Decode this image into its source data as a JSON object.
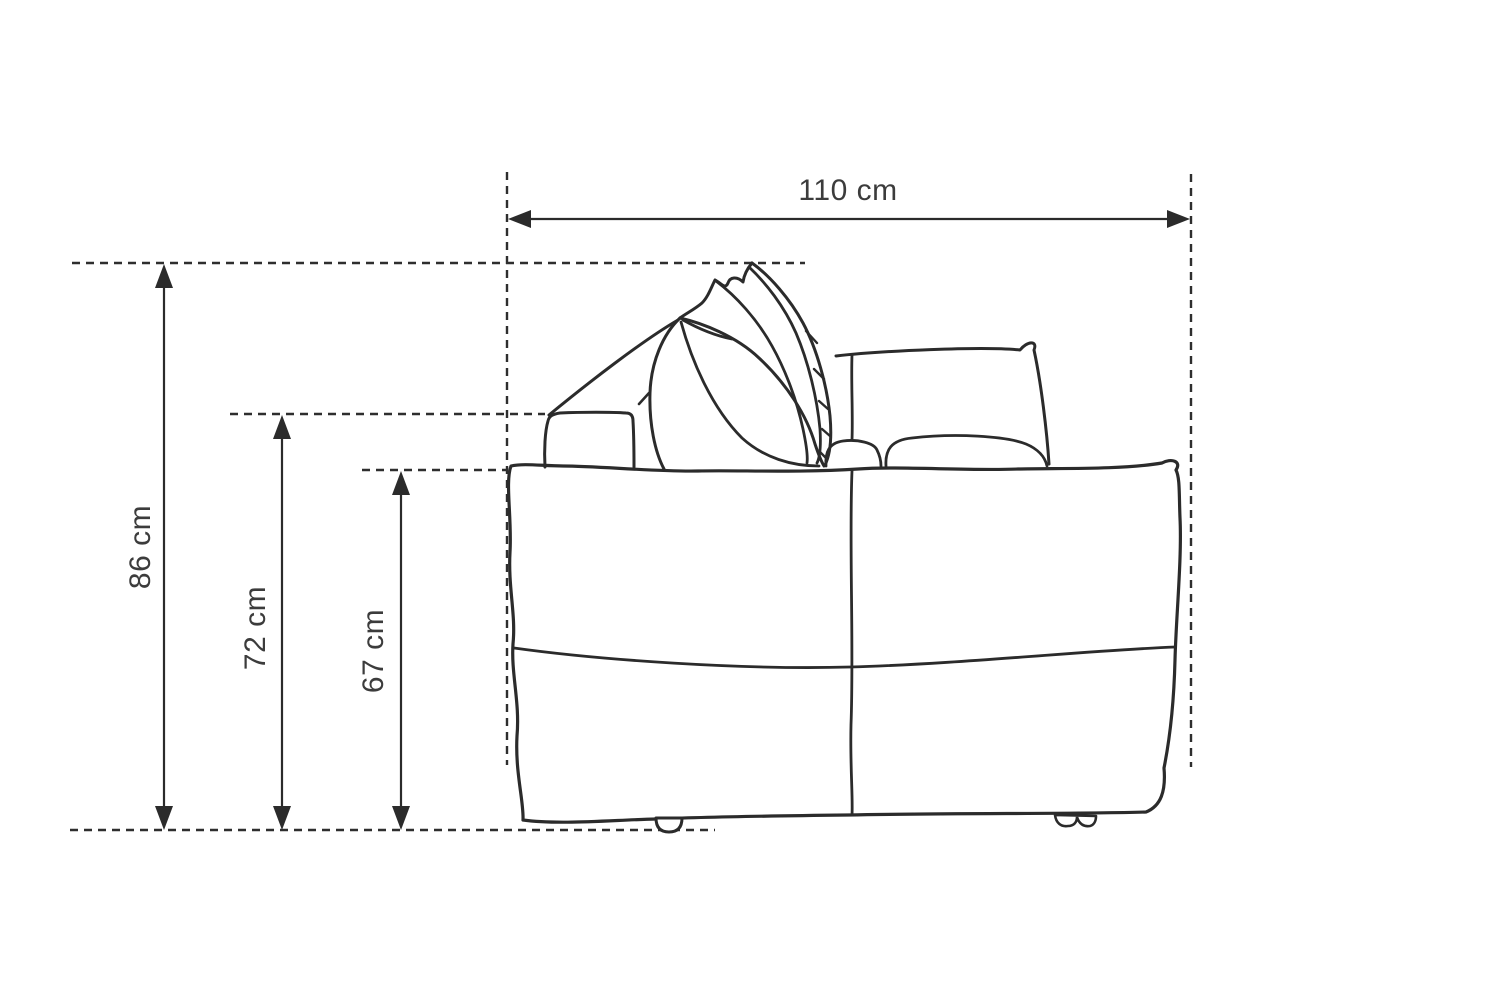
{
  "diagram": {
    "subject": "sofa side-view line drawing with dimension annotations",
    "unit": "cm",
    "background": "#ffffff",
    "line_color": "#2b2b2b",
    "text_color": "#3c3c3c",
    "dimensions": {
      "overall_width": {
        "label": "110 cm",
        "value": 110,
        "axis": "horizontal"
      },
      "overall_height": {
        "label": "86 cm",
        "value": 86,
        "axis": "vertical"
      },
      "backrest_height": {
        "label": "72 cm",
        "value": 72,
        "axis": "vertical"
      },
      "seat_back_height": {
        "label": "67 cm",
        "value": 67,
        "axis": "vertical"
      }
    }
  }
}
